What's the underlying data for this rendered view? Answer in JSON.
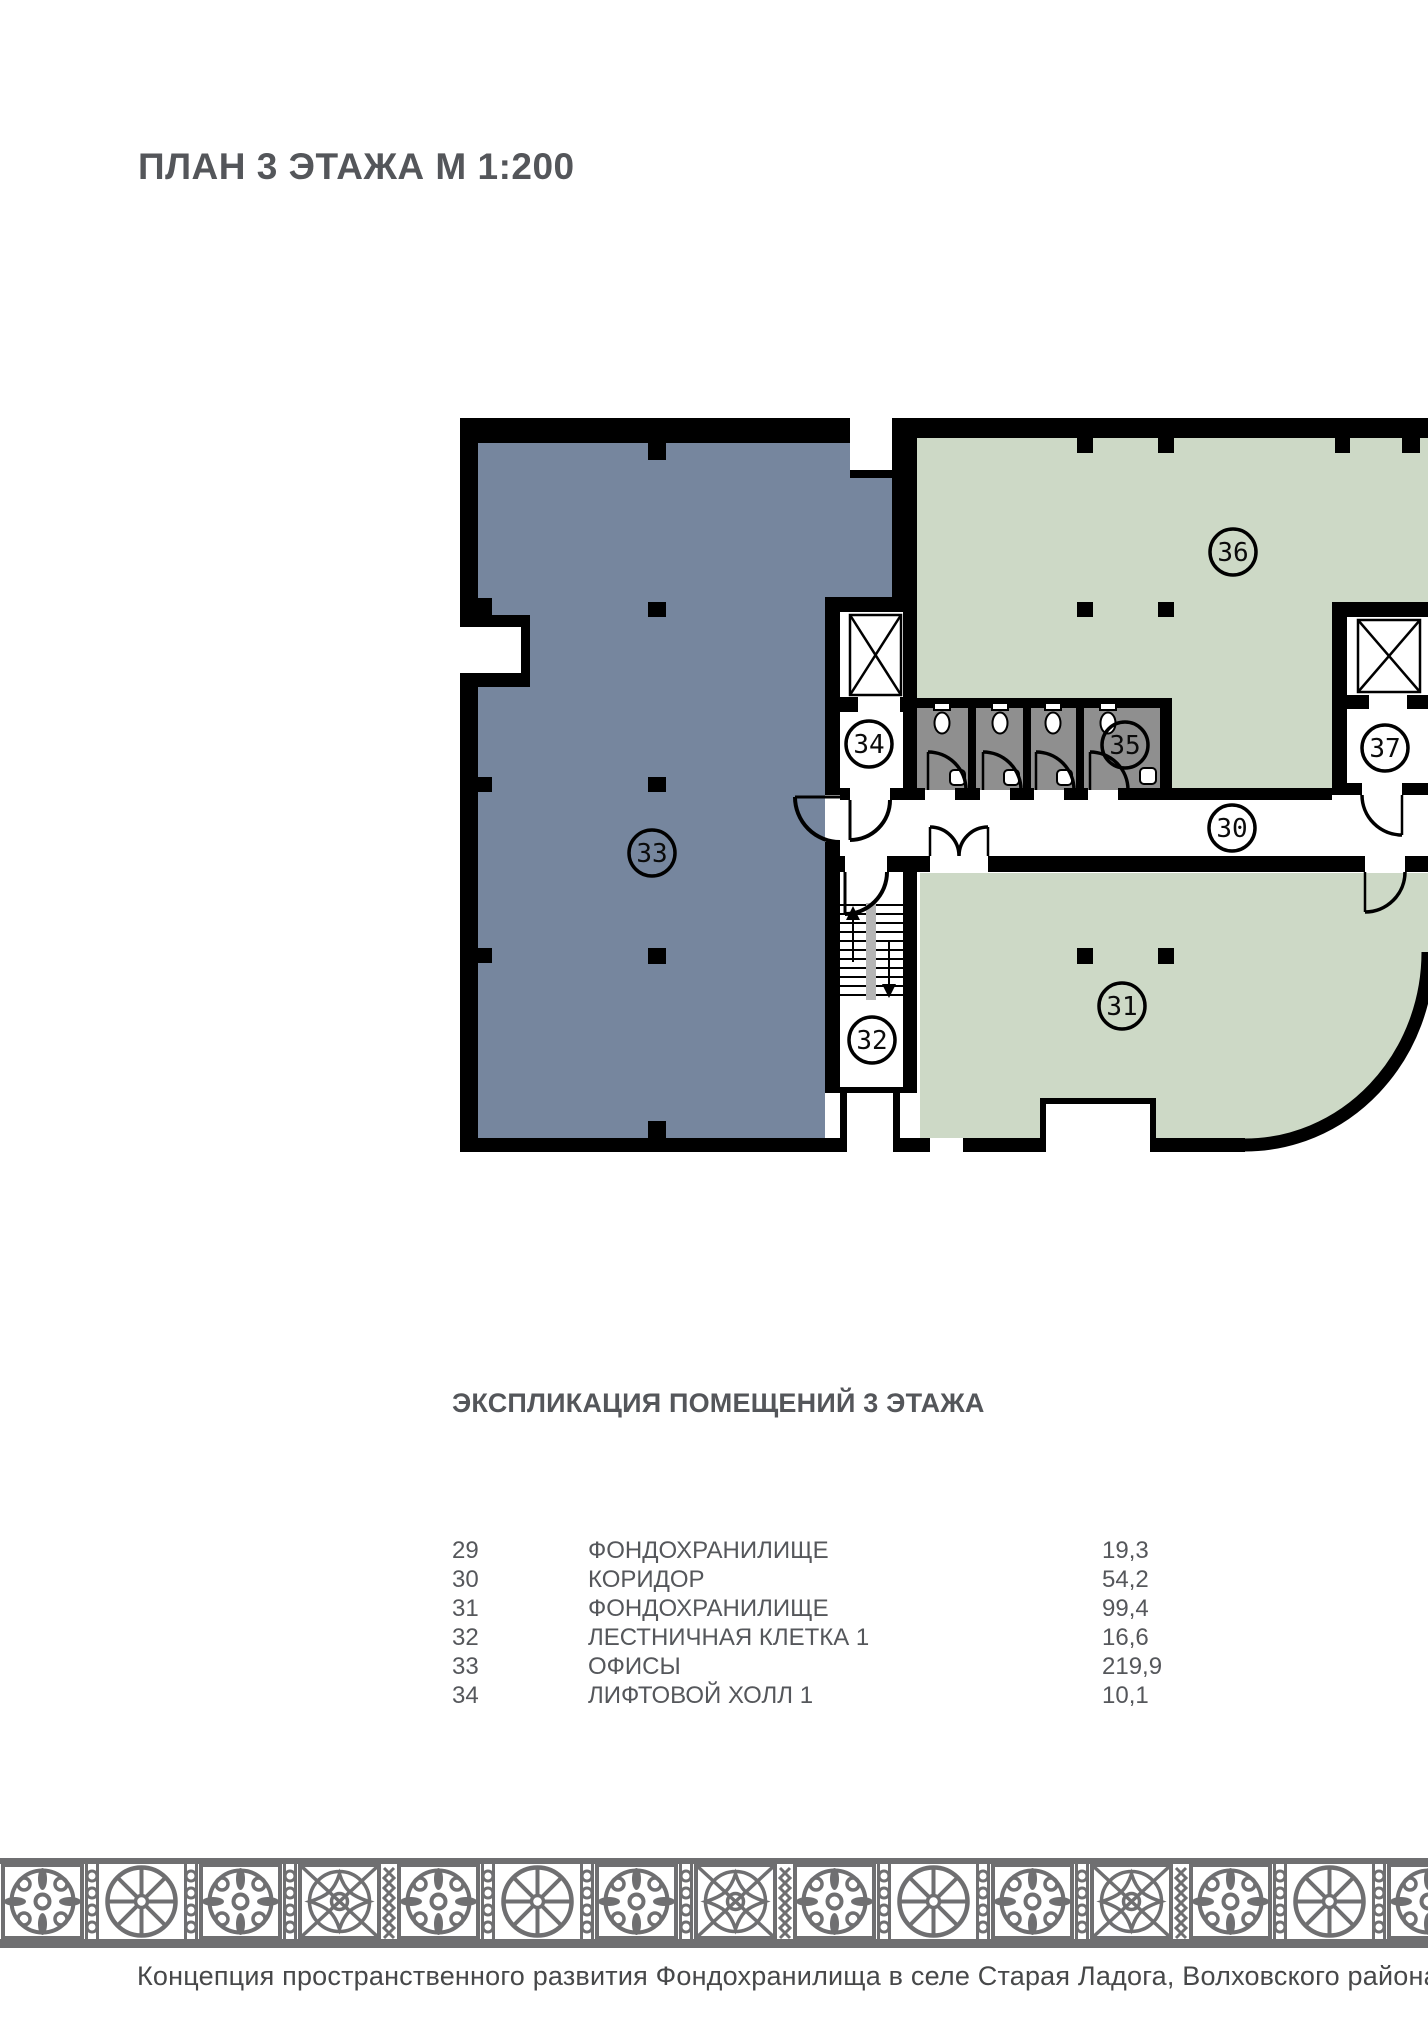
{
  "title": "ПЛАН 3 ЭТАЖА М 1:200",
  "plan": {
    "labels": {
      "r30": "30",
      "r31": "31",
      "r32": "32",
      "r33": "33",
      "r34": "34",
      "r35": "35",
      "r36": "36",
      "r37": "37"
    },
    "colors": {
      "office_blue": "#76869E",
      "storage_green": "#CDD9C6",
      "wc_gray": "#8F8F8F",
      "wall_black": "#000000",
      "stair_stripe": "#B5B5B5"
    }
  },
  "explication": {
    "heading": "ЭКСПЛИКАЦИЯ ПОМЕЩЕНИЙ 3 ЭТАЖА",
    "rows": [
      {
        "num": "29",
        "name": "ФОНДОХРАНИЛИЩЕ",
        "area": "19,3"
      },
      {
        "num": "30",
        "name": "КОРИДОР",
        "area": "54,2"
      },
      {
        "num": "31",
        "name": "ФОНДОХРАНИЛИЩЕ",
        "area": "99,4"
      },
      {
        "num": "32",
        "name": "ЛЕСТНИЧНАЯ КЛЕТКА 1",
        "area": "16,6"
      },
      {
        "num": "33",
        "name": "ОФИСЫ",
        "area": "219,9"
      },
      {
        "num": "34",
        "name": "ЛИФТОВОЙ ХОЛЛ 1",
        "area": "10,1"
      }
    ]
  },
  "footer": {
    "caption": "Концепция пространственного развития Фондохранилища в селе Старая Ладога, Волховского района, Ленинградско"
  },
  "ornament": {
    "color": "#6F6F71"
  }
}
